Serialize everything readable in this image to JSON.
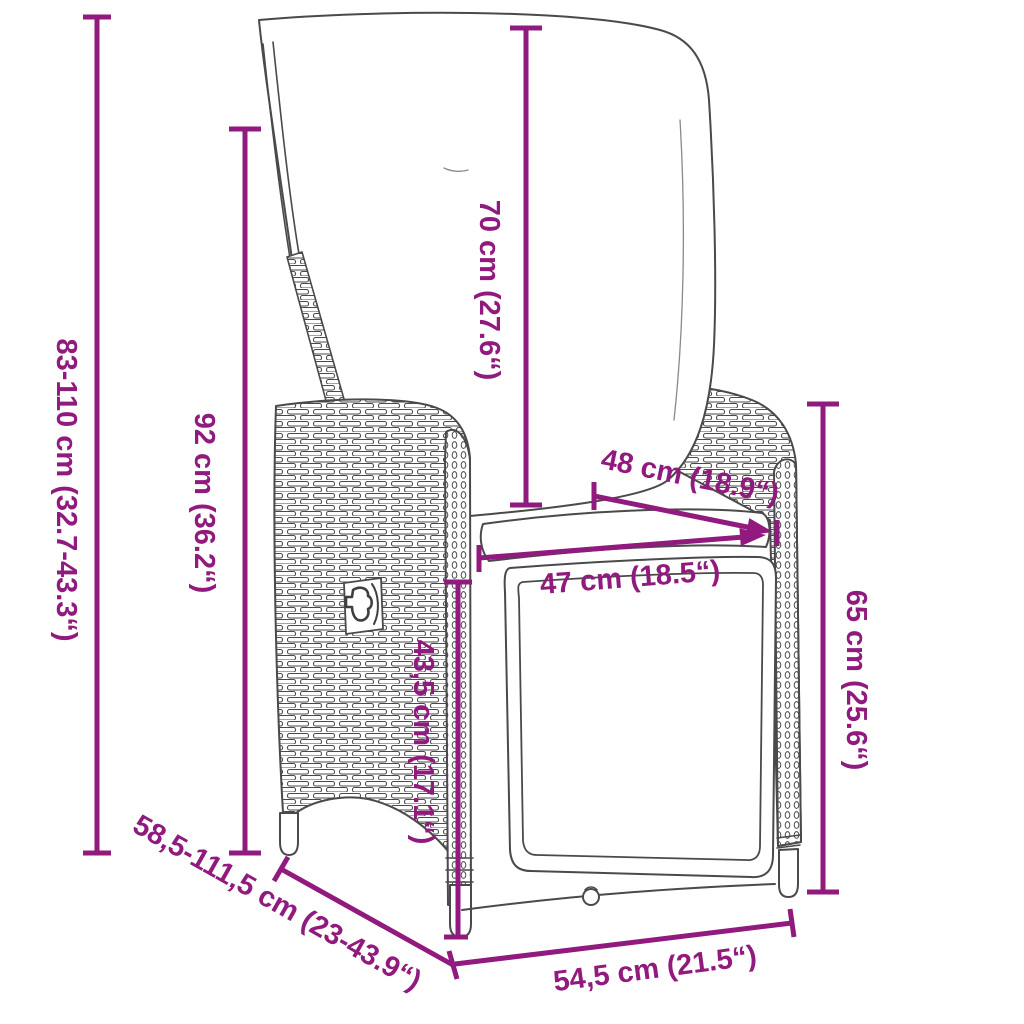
{
  "figure": {
    "kind": "product-dimension-diagram",
    "subject": "reclining-garden-chair-with-cushions",
    "accent_color": "#901a7d",
    "line_color": "#4a4a4a",
    "background_color": "#ffffff"
  },
  "dimensions": [
    {
      "name": "overall-height-range",
      "label": "83-110 cm (32.7-43.3“)"
    },
    {
      "name": "backrest-height",
      "label": "92 cm (36.2“)"
    },
    {
      "name": "back-cushion-height",
      "label": "70 cm (27.6“)"
    },
    {
      "name": "backrest-width",
      "label": "48 cm (18.9“)"
    },
    {
      "name": "seat-width",
      "label": "47 cm (18.5“)"
    },
    {
      "name": "seat-height",
      "label": "43,5 cm (17.1“)"
    },
    {
      "name": "armrest-height",
      "label": "65 cm (25.6“)"
    },
    {
      "name": "depth-reclined-range",
      "label": "58,5-111,5 cm (23-43.9“)"
    },
    {
      "name": "base-depth",
      "label": "54,5 cm (21.5“)"
    }
  ]
}
